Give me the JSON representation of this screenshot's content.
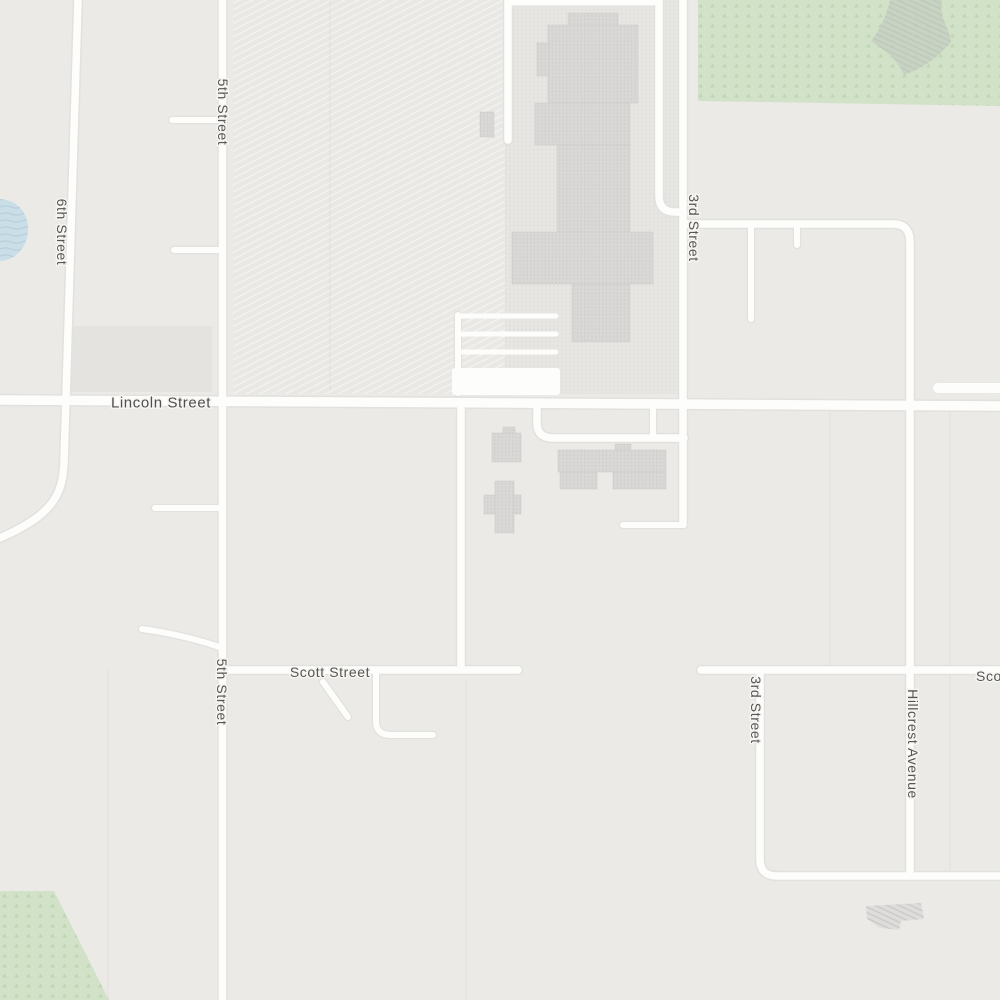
{
  "map": {
    "view": "street-map-light",
    "colors": {
      "background": "#ebeae7",
      "road_fill": "#fdfdfc",
      "road_casing": "#e2e1de",
      "park_green": "#d2e2c8",
      "park_pattern_green": "#c0d5b2",
      "scrub_blob_green": "#c6d0c2",
      "water_blue": "#cadee7",
      "building_gray": "#d9d8d6",
      "campus_ground": "#e7e6e3",
      "hatch_ground": "#e9e8e5",
      "label_gray": "#565656"
    },
    "street_labels": [
      {
        "name": "Lincoln Street",
        "orientation": "horizontal"
      },
      {
        "name": "Scott Street",
        "orientation": "horizontal"
      },
      {
        "name": "Scott Street",
        "orientation": "horizontal-clipped-right"
      },
      {
        "name": "5th Street",
        "orientation": "vertical"
      },
      {
        "name": "5th Street",
        "orientation": "vertical"
      },
      {
        "name": "6th Street",
        "orientation": "vertical"
      },
      {
        "name": "3rd Street",
        "orientation": "vertical"
      },
      {
        "name": "3rd Street",
        "orientation": "vertical"
      },
      {
        "name": "Hillcrest Avenue",
        "orientation": "vertical"
      }
    ],
    "areas": [
      {
        "kind": "forest-park",
        "position": "top-right"
      },
      {
        "kind": "forest-park",
        "position": "bottom-left"
      },
      {
        "kind": "pond",
        "position": "left-edge"
      },
      {
        "kind": "school-grounds-hatched",
        "position": "top-center"
      },
      {
        "kind": "building-complex",
        "position": "top-center"
      },
      {
        "kind": "buildings",
        "position": "center-below-lincoln"
      },
      {
        "kind": "hatched-structure",
        "position": "bottom-right"
      }
    ]
  }
}
